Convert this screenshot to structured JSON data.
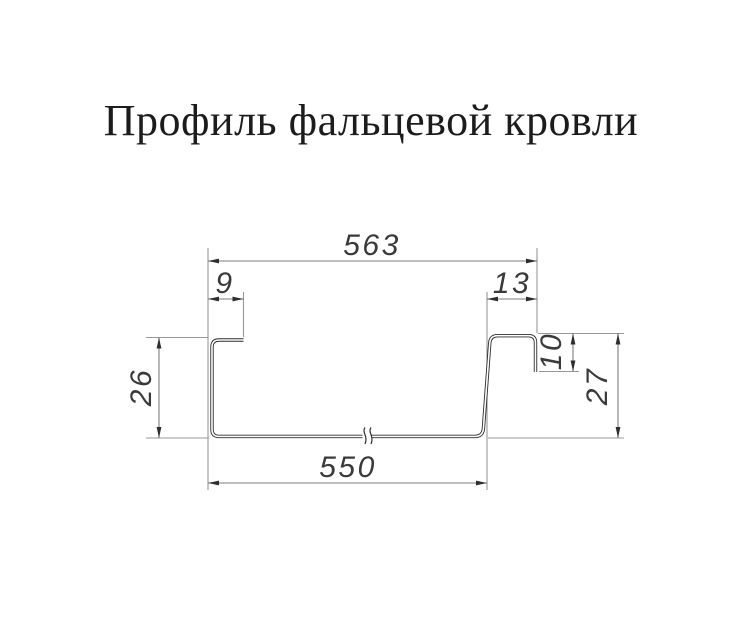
{
  "title": "Профиль фальцевой кровли",
  "drawing": {
    "type": "technical-cross-section",
    "subject": "standing-seam-roofing-profile",
    "units": "mm",
    "dims": {
      "top_overall": "563",
      "left_lip": "9",
      "right_seam_width": "13",
      "left_height": "26",
      "seam_drop": "10",
      "right_height": "27",
      "bottom_width": "550"
    }
  },
  "colors": {
    "background": "#ffffff",
    "profile_line": "#2e2e2e",
    "extension_line": "#989898",
    "dimension_line": "#7d7d7d",
    "arrow": "#2e2e2e",
    "dimension_text": "#3a3a3a",
    "title_text": "#1c1c1c"
  }
}
